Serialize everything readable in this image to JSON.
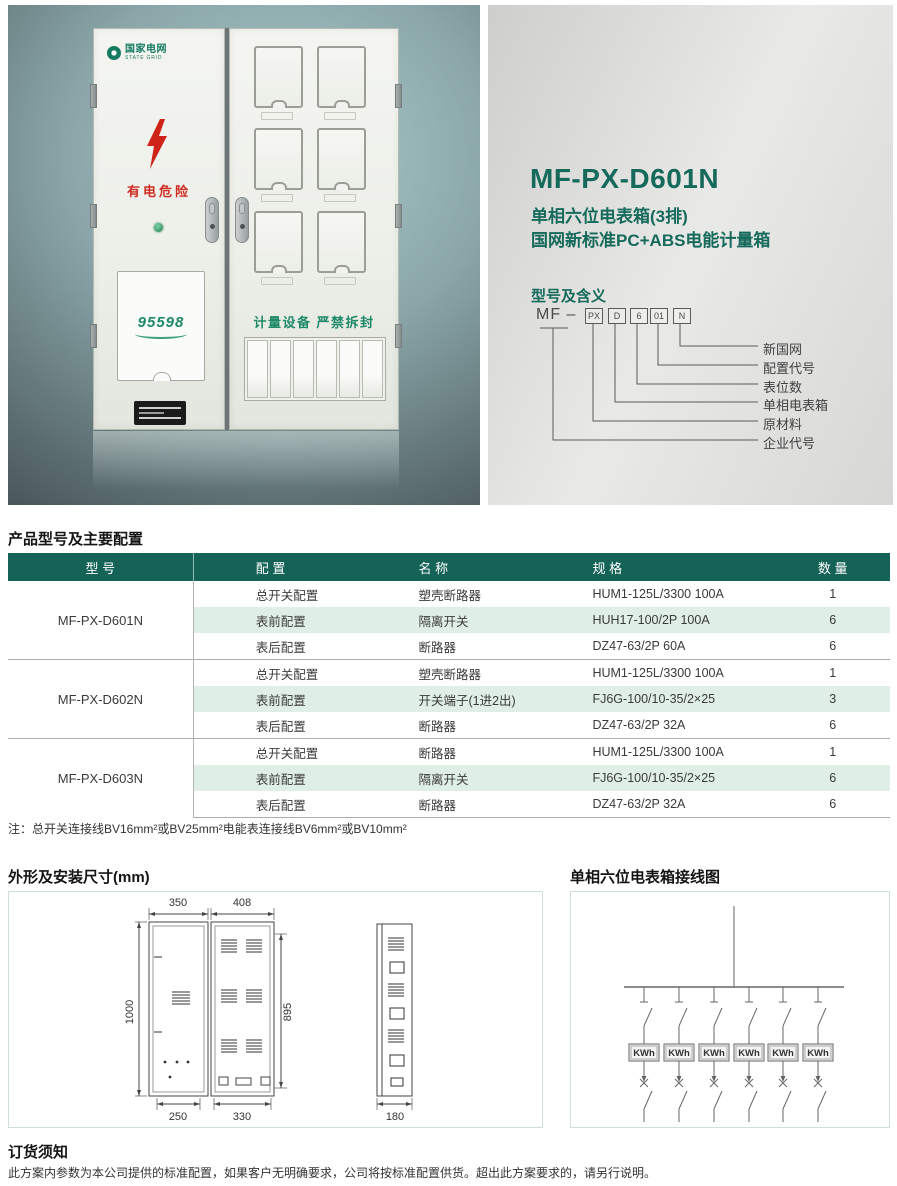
{
  "hero": {
    "title": "MF-PX-D601N",
    "subtitle_line1": "单相六位电表箱(3排)",
    "subtitle_line2": "国网新标准PC+ABS电能计量箱",
    "accent_color": "#156a5c",
    "photo": {
      "brand_name": "国家电网",
      "brand_sub": "STATE GRID",
      "danger_label": "有电危险",
      "service_logo": "95598",
      "seal_label": "计量设备  严禁拆封"
    },
    "code_meaning": {
      "heading": "型号及含义",
      "prefix": "MF –",
      "segments": [
        "PX",
        "D",
        "6",
        "01",
        "N"
      ],
      "labels": [
        "新国网",
        "配置代号",
        "表位数",
        "单相电表箱",
        "原材料",
        "企业代号"
      ]
    }
  },
  "config_table": {
    "heading": "产品型号及主要配置",
    "header_bg": "#156356",
    "alt_row_bg": "#e0efe5",
    "headers": [
      "型 号",
      "配 置",
      "名 称",
      "规 格",
      "数 量"
    ],
    "groups": [
      {
        "model": "MF-PX-D601N",
        "rows": [
          {
            "config": "总开关配置",
            "name": "塑壳断路器",
            "spec": "HUM1-125L/3300 100A",
            "qty": "1"
          },
          {
            "config": "表前配置",
            "name": "隔离开关",
            "spec": "HUH17-100/2P 100A",
            "qty": "6"
          },
          {
            "config": "表后配置",
            "name": "断路器",
            "spec": "DZ47-63/2P 60A",
            "qty": "6"
          }
        ]
      },
      {
        "model": "MF-PX-D602N",
        "rows": [
          {
            "config": "总开关配置",
            "name": "塑壳断路器",
            "spec": "HUM1-125L/3300 100A",
            "qty": "1"
          },
          {
            "config": "表前配置",
            "name": "开关端子(1进2出)",
            "spec": "FJ6G-100/10-35/2×25",
            "qty": "3"
          },
          {
            "config": "表后配置",
            "name": "断路器",
            "spec": "DZ47-63/2P 32A",
            "qty": "6"
          }
        ]
      },
      {
        "model": "MF-PX-D603N",
        "rows": [
          {
            "config": "总开关配置",
            "name": "断路器",
            "spec": "HUM1-125L/3300 100A",
            "qty": "1"
          },
          {
            "config": "表前配置",
            "name": "隔离开关",
            "spec": "FJ6G-100/10-35/2×25",
            "qty": "6"
          },
          {
            "config": "表后配置",
            "name": "断路器",
            "spec": "DZ47-63/2P 32A",
            "qty": "6"
          }
        ]
      }
    ],
    "note": "注：总开关连接线BV16mm²或BV25mm²电能表连接线BV6mm²或BV10mm²"
  },
  "dimensions": {
    "heading": "外形及安装尺寸(mm)",
    "labels": {
      "top_left": "350",
      "top_right": "408",
      "left_height": "1000",
      "inner_height": "895",
      "bottom_left": "250",
      "bottom_right": "330",
      "depth": "180"
    }
  },
  "wiring": {
    "heading": "单相六位电表箱接线图",
    "meters": [
      "KWh",
      "KWh",
      "KWh",
      "KWh",
      "KWh",
      "KWh"
    ]
  },
  "footer": {
    "heading": "订货须知",
    "text": "此方案内参数为本公司提供的标准配置，如果客户无明确要求，公司将按标准配置供货。超出此方案要求的，请另行说明。"
  }
}
